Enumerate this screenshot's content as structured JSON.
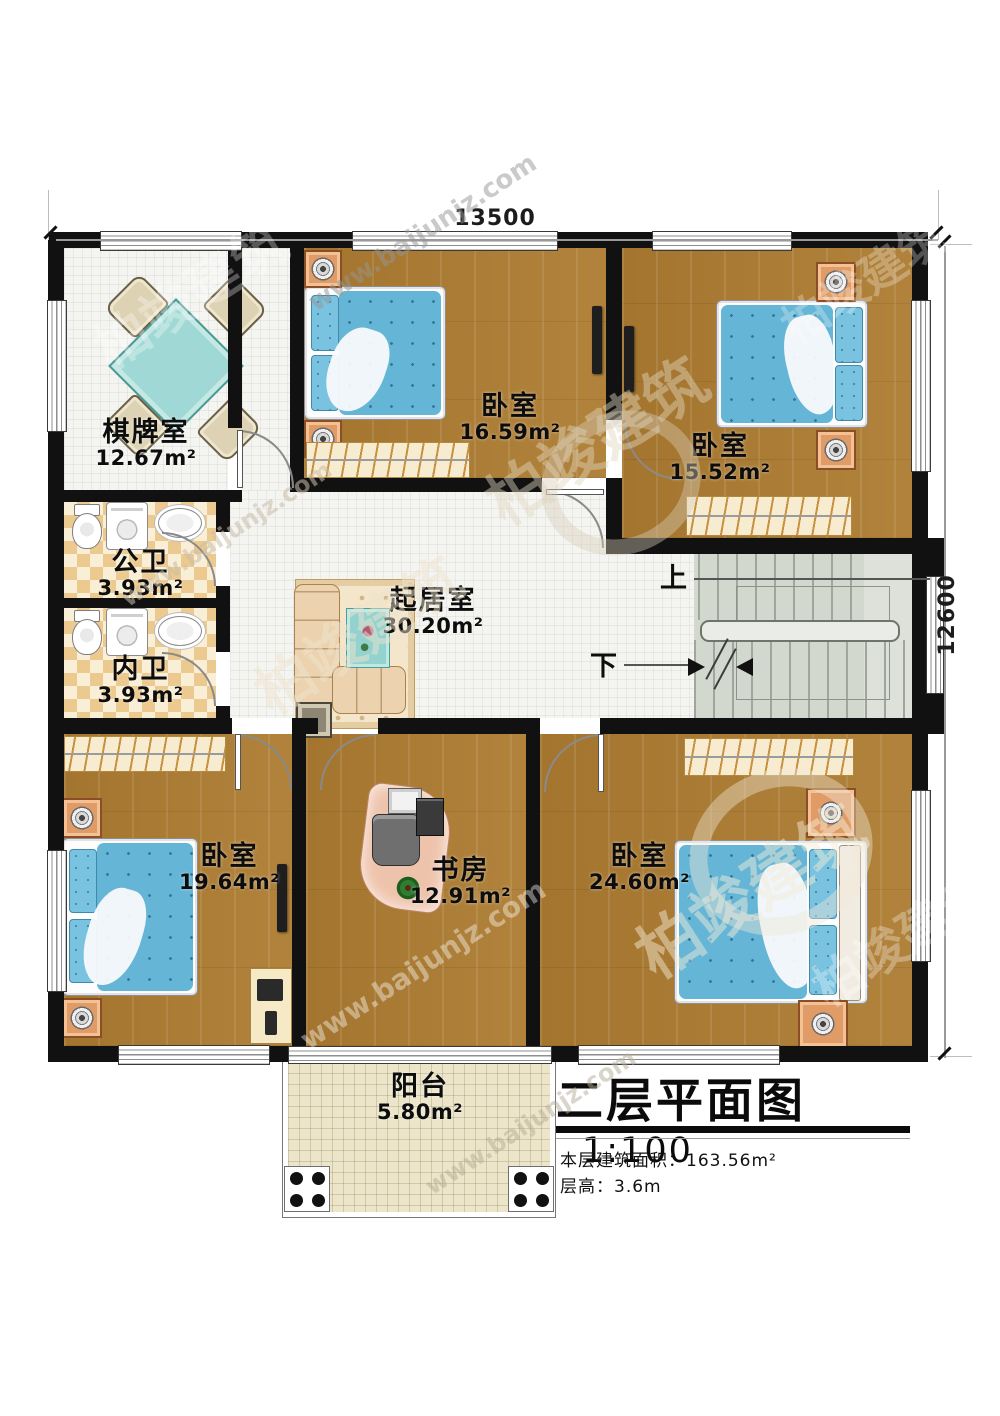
{
  "plan": {
    "dimension_top": "13500",
    "dimension_right": "12600",
    "rooms": [
      {
        "name": "棋牌室",
        "area": "12.67m²"
      },
      {
        "name": "卧室",
        "area": "16.59m²"
      },
      {
        "name": "卧室",
        "area": "15.52m²"
      },
      {
        "name": "公卫",
        "area": "3.93m²"
      },
      {
        "name": "内卫",
        "area": "3.93m²"
      },
      {
        "name": "起居室",
        "area": "30.20m²"
      },
      {
        "name": "卧室",
        "area": "19.64m²"
      },
      {
        "name": "书房",
        "area": "12.91m²"
      },
      {
        "name": "卧室",
        "area": "24.60m²"
      },
      {
        "name": "阳台",
        "area": "5.80m²"
      }
    ],
    "stairs": {
      "up_label": "上",
      "down_label": "下"
    }
  },
  "title_block": {
    "title": "二层平面图",
    "scale": "1:100",
    "floor_area": "本层建筑面积：163.56m²",
    "floor_height": "层高：3.6m"
  },
  "watermark": {
    "brand": "柏竣建筑",
    "site": "www.baijunjz.com"
  },
  "colors": {
    "wall": "#111111",
    "wood": "#ad7c31",
    "tile": "#f4f4f1",
    "checker_a": "#ecc98e",
    "checker_b": "#f9efd6",
    "stair": "#d3d8cf",
    "balcony": "#ece5ca",
    "bed_blue": "#64b5d6",
    "copper": "#d08252"
  }
}
